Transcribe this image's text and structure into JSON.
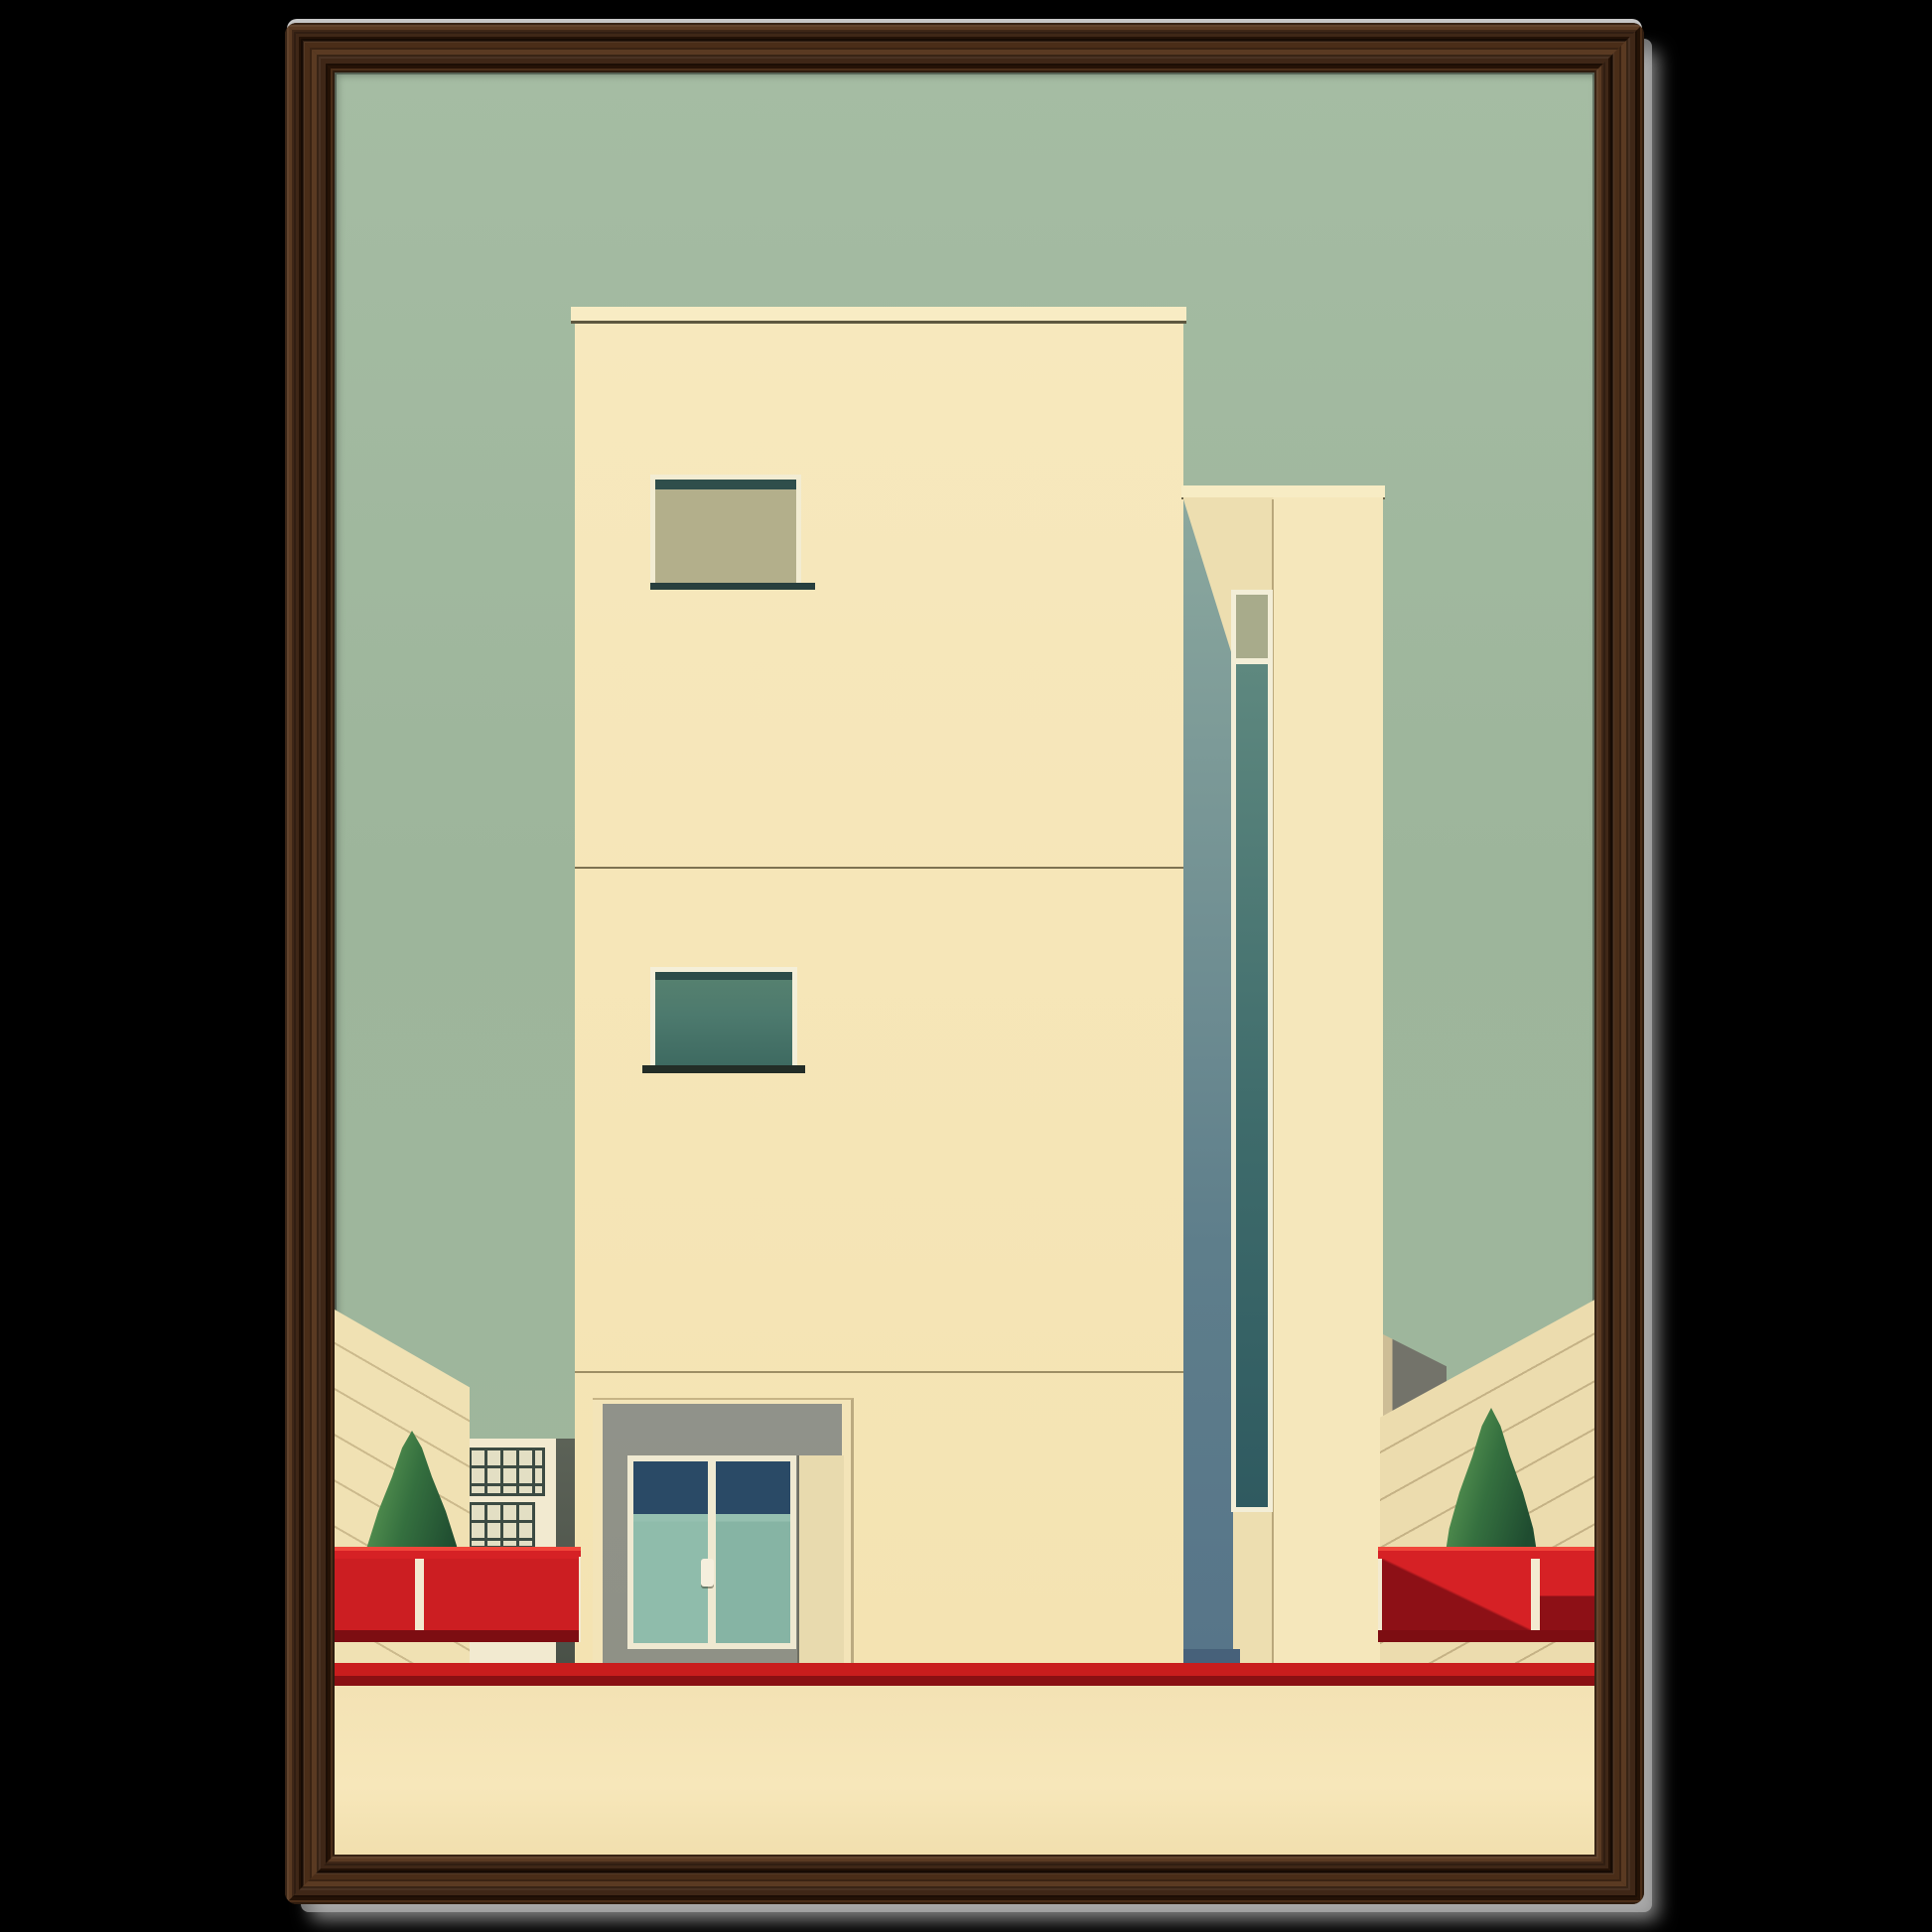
{
  "artwork": {
    "kind": "framed art print (no text visible)",
    "subject": "minimalist mid-century architecture: cream tower with windows and double door, side tower with vertical glazing, red fences, two conical trees, sage sky",
    "frame_material": "dark walnut wood, vertical grain"
  },
  "colors": {
    "bg": "#000000",
    "wood": "#3f2717",
    "wood_dark": "#241206",
    "wood_light": "#5a3a22",
    "shadow_gray": "#c6c6c6",
    "sky": "#9db59b",
    "sky_top": "#a5bca3",
    "cream_face": "#f7e8bd",
    "cream_face_shadow": "#eddeb0",
    "ground": "#f7e7ba",
    "ground_dark": "#f1dfae",
    "parapet_line": "#5e5840",
    "slate_bar": "#2f4e4b",
    "olive_glass": "#b3af8b",
    "teal_glass": "#4d7a6e",
    "strip_teal": "#3e6b6b",
    "navy_glass": "#2a4a66",
    "door_teal": "#8fbcab",
    "recess_gray": "#8f9186",
    "tower_shadow_top": "#8ba89e",
    "tower_shadow_bottom": "#577589",
    "tower_base": "#47617a",
    "wall_tan": "#ecdcae",
    "wall_cream": "#f0e1b3",
    "joint_brown": "#968054",
    "bldg_white": "#f2ead0",
    "win_grid": "#3c4b43",
    "dark_wall": "#4a5148",
    "gray_block": "#73736a",
    "tree_dark": "#1f4c30",
    "tree_mid": "#35703f",
    "tree_light": "#5d9a55",
    "red_bright": "#d62125",
    "red_panel": "#cc1e22",
    "red_dark": "#8d1016",
    "red_lip": "#7d0d12",
    "stripe_red": "#c91d1d",
    "stripe_maroon": "#8a1013"
  }
}
